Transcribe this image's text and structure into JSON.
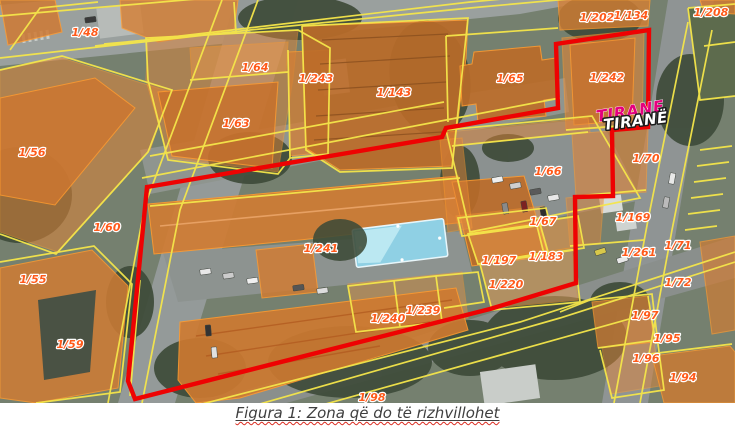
{
  "figure": {
    "caption": "Figura 1: Zona që do të rizhvillohet"
  },
  "map": {
    "colors": {
      "boundary_red": "#ee0202",
      "cadastral_yellow": "#f5e64a",
      "parcel_orange": "#e07c30",
      "label_orange": "#ff5a1a",
      "city_magenta": "#e5007e",
      "city_white": "#ffffff",
      "pool_blue": "#8fd0e4"
    },
    "city_labels": [
      {
        "text": "TIRANE",
        "style": "magenta",
        "x": 597,
        "y": 122,
        "rotate": -9
      },
      {
        "text": "TIRANË",
        "style": "white",
        "x": 604,
        "y": 130,
        "rotate": -7
      }
    ],
    "parcel_labels": [
      {
        "text": "1/48",
        "x": 85,
        "y": 36
      },
      {
        "text": "1/202",
        "x": 597,
        "y": 21
      },
      {
        "text": "1/134",
        "x": 631,
        "y": 19
      },
      {
        "text": "1/208",
        "x": 711,
        "y": 16
      },
      {
        "text": "1/64",
        "x": 255,
        "y": 71
      },
      {
        "text": "1/243",
        "x": 316,
        "y": 82
      },
      {
        "text": "1/143",
        "x": 394,
        "y": 96
      },
      {
        "text": "1/65",
        "x": 510,
        "y": 82
      },
      {
        "text": "1/242",
        "x": 607,
        "y": 81
      },
      {
        "text": "1/63",
        "x": 236,
        "y": 127
      },
      {
        "text": "1/56",
        "x": 32,
        "y": 156
      },
      {
        "text": "1/70",
        "x": 646,
        "y": 162
      },
      {
        "text": "1/66",
        "x": 548,
        "y": 175
      },
      {
        "text": "1/67",
        "x": 543,
        "y": 225
      },
      {
        "text": "1/60",
        "x": 107,
        "y": 231
      },
      {
        "text": "1/169",
        "x": 633,
        "y": 221
      },
      {
        "text": "1/241",
        "x": 321,
        "y": 252
      },
      {
        "text": "1/197",
        "x": 499,
        "y": 264
      },
      {
        "text": "1/183",
        "x": 546,
        "y": 260
      },
      {
        "text": "1/261",
        "x": 639,
        "y": 256
      },
      {
        "text": "1/71",
        "x": 678,
        "y": 249
      },
      {
        "text": "1/220",
        "x": 506,
        "y": 288
      },
      {
        "text": "1/72",
        "x": 678,
        "y": 286
      },
      {
        "text": "1/55",
        "x": 33,
        "y": 283
      },
      {
        "text": "1/59",
        "x": 70,
        "y": 348
      },
      {
        "text": "1/240",
        "x": 388,
        "y": 322
      },
      {
        "text": "1/239",
        "x": 423,
        "y": 314
      },
      {
        "text": "1/97",
        "x": 645,
        "y": 319
      },
      {
        "text": "1/95",
        "x": 667,
        "y": 342
      },
      {
        "text": "1/96",
        "x": 646,
        "y": 362
      },
      {
        "text": "1/94",
        "x": 683,
        "y": 381
      },
      {
        "text": "1/98",
        "x": 372,
        "y": 401
      }
    ]
  }
}
